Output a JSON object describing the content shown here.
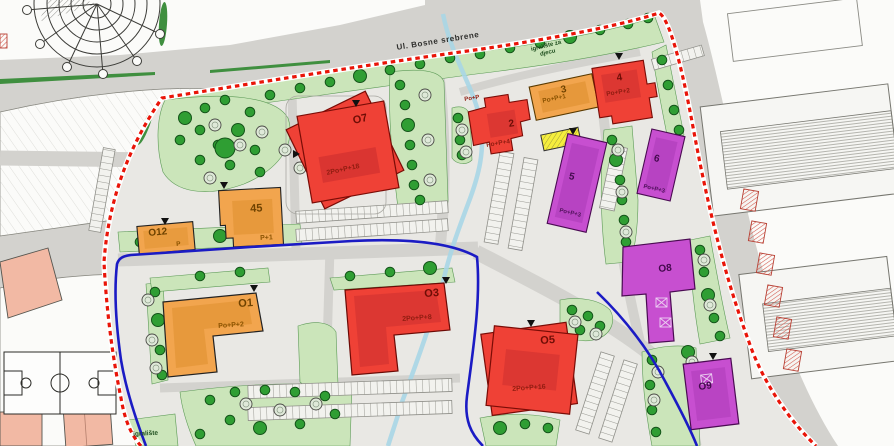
{
  "map": {
    "streets": {
      "top": "Ul. Bosne srebrene"
    },
    "areas": {
      "playground_children": "igralište za djecu",
      "playground": "igralište"
    },
    "buildings": {
      "o7": {
        "id": "O7",
        "floors": "2Po+P+18"
      },
      "b45": {
        "id": "45",
        "floors": "P+1"
      },
      "o12": {
        "id": "O12",
        "floors": "P"
      },
      "b2": {
        "id": "2",
        "floors": "Po+P+4",
        "wing": "Po+P"
      },
      "b3": {
        "id": "3",
        "floors": "Po+P+1"
      },
      "b4": {
        "id": "4",
        "floors": "Po+P+2"
      },
      "b5": {
        "id": "5",
        "floors": "Po+P+3"
      },
      "b6": {
        "id": "6",
        "floors": "Po+P+3"
      },
      "o1": {
        "id": "O1",
        "floors": "Po+P+2"
      },
      "o3": {
        "id": "O3",
        "floors": "2Po+P+8"
      },
      "o5": {
        "id": "O5",
        "floors": "2Po+P+16"
      },
      "o8": {
        "id": "O8"
      },
      "o9": {
        "id": "O9"
      }
    },
    "palette": {
      "plan_boundary_red": "#e91408",
      "secondary_boundary_blue": "#1b1bc4",
      "building_red": "#ef4136",
      "building_orange": "#f2a54e",
      "building_purple": "#c74fd0",
      "building_yellow": "#f5ee3d",
      "existing_pink": "#f2b9a4",
      "green_area": "#cbe5ba",
      "water": "#a9d6e6",
      "road_gray": "#d3d2ce"
    }
  }
}
